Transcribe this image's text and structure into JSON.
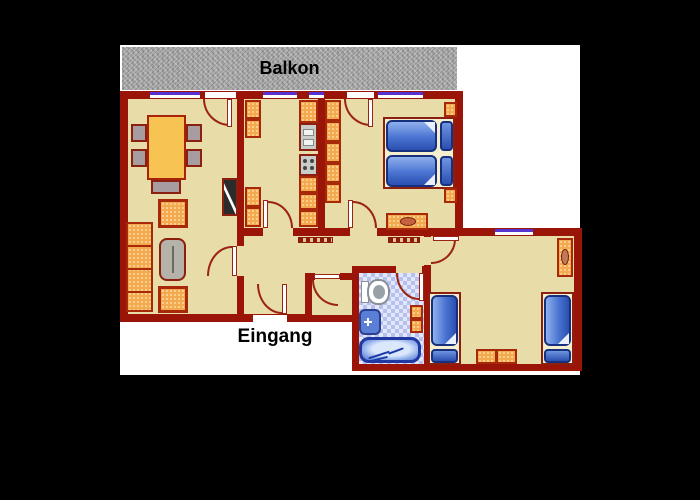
{
  "labels": {
    "balcony": "Balkon",
    "entrance": "Eingang"
  },
  "palette": {
    "background": "#000000",
    "canvas": "#ffffff",
    "wall": "#9a1507",
    "floor_tan": "#e8dca8",
    "furniture_orange": "#f3a94e",
    "furniture_border": "#a8290a",
    "bed_blue": "#4a74d2",
    "bed_frame_cream": "#f5efd0",
    "window_purple": "#5633d1",
    "balcony_gray": "#acacac",
    "bath_tile_blue": "#b6c0ef",
    "door_arc_red": "#9a2313"
  },
  "elements": {
    "living_room": [
      "dining-table",
      "dining-chair x5",
      "tv",
      "armchair x2",
      "coffee-table",
      "sofa"
    ],
    "kitchen": [
      "cabinet x4",
      "sink",
      "stove",
      "counter"
    ],
    "bedroom_double": [
      "wardrobe",
      "double-bed",
      "pillow x2",
      "nightstand x2",
      "dresser"
    ],
    "hallway": [
      "radiator x2",
      "entrance-door"
    ],
    "bathroom": [
      "toilet",
      "washbasin",
      "cabinet",
      "bathtub"
    ],
    "bedroom_twin": [
      "single-bed x2",
      "pillow x2",
      "mirror-dresser",
      "side-table x2"
    ],
    "openings": [
      "window x5",
      "balcony-door x2",
      "room-door x7"
    ]
  }
}
